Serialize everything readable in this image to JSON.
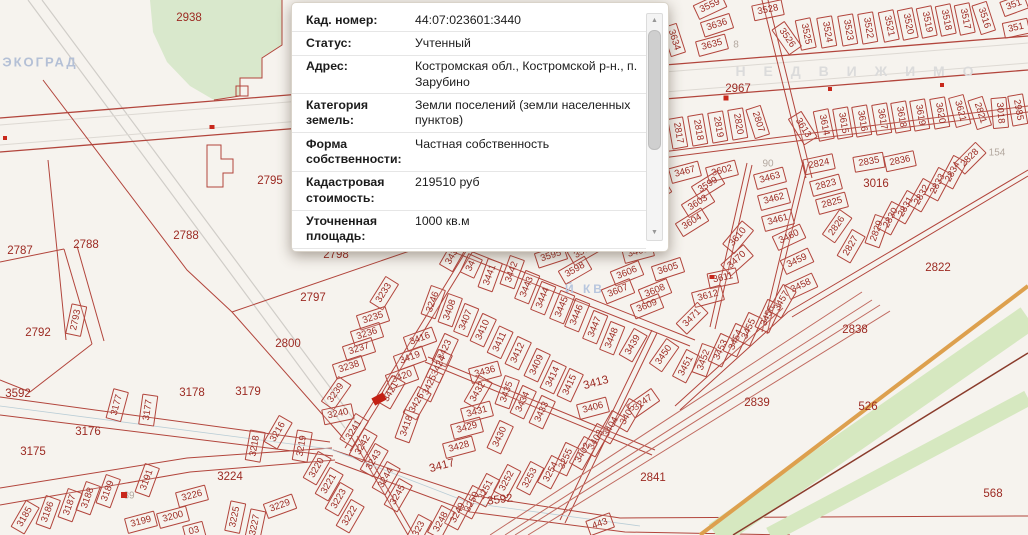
{
  "popup": {
    "rows": [
      {
        "label": "Кад. номер:",
        "value": "44:07:023601:3440"
      },
      {
        "label": "Статус:",
        "value": "Учтенный"
      },
      {
        "label": "Адрес:",
        "value": "Костромская обл., Костромской р-н., п. Зарубино"
      },
      {
        "label": "Категория земель:",
        "value": "Земли поселений (земли населенных пунктов)"
      },
      {
        "label": "Форма собственности:",
        "value": "Частная собственность"
      },
      {
        "label": "Кадастровая стоимость:",
        "value": "219510 руб"
      },
      {
        "label": "Уточненная площадь:",
        "value": "1000 кв.м"
      },
      {
        "label": "",
        "value": "Для индивидуального жилищного"
      }
    ],
    "scrollbar": {
      "up": "▲",
      "down": "▼"
    }
  },
  "colors": {
    "parcel_line": "#b2453c",
    "parcel_label": "#9c2a22",
    "muted_label": "#b3a89f",
    "marker": "#c8281c",
    "selected": "#c32014",
    "forest_green": "#d9e8cc",
    "rail_green": "#d6e8c0",
    "rail_orange": "#dda04e",
    "watermark_blue": "#b4c0d6",
    "watermark_gray": "#dbdbdb"
  },
  "map": {
    "watermarks": [
      {
        "text": "ЭКОГРАД",
        "x": 40,
        "y": 62,
        "size": 13,
        "spacing": 2,
        "color": "#b4c0d6"
      },
      {
        "text": "Н Е Д В И Ж И М О",
        "x": 858,
        "y": 71,
        "size": 14,
        "spacing": 7,
        "color": "#dbdbdb"
      },
      {
        "text": "Й КВ",
        "x": 585,
        "y": 289,
        "size": 12,
        "spacing": 3,
        "color": "#b7c6de"
      }
    ],
    "markers": [
      {
        "x": 726,
        "y": 98,
        "w": 5,
        "h": 5
      },
      {
        "x": 830,
        "y": 89,
        "w": 4,
        "h": 4
      },
      {
        "x": 942,
        "y": 85,
        "w": 4,
        "h": 4
      },
      {
        "x": 212,
        "y": 127,
        "w": 5,
        "h": 4
      },
      {
        "x": 5,
        "y": 138,
        "w": 4,
        "h": 4
      },
      {
        "x": 124,
        "y": 495,
        "w": 6,
        "h": 6
      },
      {
        "x": 712,
        "y": 277,
        "w": 5,
        "h": 4
      },
      {
        "x": 379,
        "y": 399,
        "w": 13,
        "h": 8,
        "r": -28,
        "sel": true
      }
    ],
    "parcels": [
      [
        "3559",
        710,
        6,
        -25
      ],
      [
        "3636",
        717,
        25,
        -18
      ],
      [
        "3634",
        674,
        40,
        72
      ],
      [
        "3635",
        712,
        45,
        -15
      ],
      [
        "8",
        736,
        45,
        0,
        "m"
      ],
      [
        "3528",
        768,
        10,
        -12
      ],
      [
        "3526",
        787,
        38,
        55
      ],
      [
        "3525",
        806,
        34,
        78
      ],
      [
        "3524",
        827,
        32,
        80
      ],
      [
        "3523",
        848,
        30,
        80
      ],
      [
        "3522",
        868,
        28,
        80
      ],
      [
        "3521",
        889,
        26,
        78
      ],
      [
        "3520",
        908,
        24,
        78
      ],
      [
        "3519",
        927,
        22,
        78
      ],
      [
        "3518",
        946,
        20,
        78
      ],
      [
        "3517",
        965,
        19,
        78
      ],
      [
        "3516",
        984,
        18,
        72
      ],
      [
        "351",
        1014,
        5,
        -20
      ],
      [
        "351",
        1016,
        28,
        -12
      ],
      [
        "2967",
        738,
        89,
        0,
        "p"
      ],
      [
        "2817",
        678,
        133,
        80
      ],
      [
        "2818",
        698,
        130,
        80
      ],
      [
        "2819",
        718,
        127,
        80
      ],
      [
        "2820",
        738,
        124,
        80
      ],
      [
        "2807",
        758,
        122,
        72
      ],
      [
        "90",
        768,
        164,
        0,
        "m"
      ],
      [
        "3613",
        803,
        128,
        58
      ],
      [
        "3614",
        824,
        125,
        78
      ],
      [
        "3615",
        843,
        123,
        80
      ],
      [
        "3616",
        862,
        121,
        80
      ],
      [
        "3617",
        882,
        119,
        80
      ],
      [
        "3618",
        901,
        117,
        80
      ],
      [
        "3619",
        920,
        115,
        80
      ],
      [
        "3620",
        940,
        113,
        80
      ],
      [
        "3621",
        960,
        111,
        75
      ],
      [
        "2821",
        980,
        113,
        72
      ],
      [
        "3018",
        1000,
        113,
        85
      ],
      [
        "2985",
        1018,
        110,
        80
      ],
      [
        "154",
        997,
        153,
        0,
        "m"
      ],
      [
        "3467",
        685,
        172,
        -15
      ],
      [
        "3602",
        722,
        171,
        -15
      ],
      [
        "3599",
        708,
        185,
        -32
      ],
      [
        "3603",
        698,
        203,
        -32
      ],
      [
        "3604",
        692,
        222,
        -32
      ],
      [
        "3600",
        655,
        193,
        -32
      ],
      [
        "3610",
        738,
        237,
        -50
      ],
      [
        "3470",
        737,
        260,
        -42
      ],
      [
        "3611",
        723,
        278,
        -12
      ],
      [
        "3612",
        708,
        296,
        -15
      ],
      [
        "3471",
        692,
        318,
        -45
      ],
      [
        "3605",
        668,
        269,
        -18
      ],
      [
        "3606",
        627,
        273,
        -22
      ],
      [
        "3607",
        618,
        291,
        -22
      ],
      [
        "3608",
        655,
        291,
        -22
      ],
      [
        "3609",
        647,
        306,
        -22
      ],
      [
        "3597",
        584,
        251,
        -30
      ],
      [
        "3598",
        575,
        270,
        -30
      ],
      [
        "3595",
        551,
        256,
        -18
      ],
      [
        "3468",
        638,
        252,
        -15
      ],
      [
        "3463",
        770,
        178,
        -15
      ],
      [
        "3462",
        774,
        199,
        -15
      ],
      [
        "3461",
        778,
        220,
        -15
      ],
      [
        "3460",
        789,
        237,
        -25
      ],
      [
        "3459",
        797,
        261,
        -25
      ],
      [
        "3458",
        801,
        286,
        -25
      ],
      [
        "3450",
        664,
        355,
        -55
      ],
      [
        "3451",
        686,
        366,
        -62
      ],
      [
        "3452",
        704,
        360,
        -70
      ],
      [
        "3453",
        721,
        350,
        -65
      ],
      [
        "3454",
        736,
        340,
        -65
      ],
      [
        "3455",
        749,
        329,
        -65
      ],
      [
        "3456",
        768,
        316,
        -65
      ],
      [
        "3457",
        782,
        301,
        -60
      ],
      [
        "2824",
        819,
        164,
        -12
      ],
      [
        "2823",
        826,
        185,
        -15
      ],
      [
        "2825",
        832,
        203,
        -15
      ],
      [
        "2826",
        837,
        226,
        -55
      ],
      [
        "2827",
        851,
        246,
        -60
      ],
      [
        "2829",
        877,
        231,
        -70
      ],
      [
        "2830",
        891,
        218,
        -62
      ],
      [
        "2831",
        906,
        207,
        -60
      ],
      [
        "2832",
        922,
        195,
        -60
      ],
      [
        "2833",
        938,
        184,
        -62
      ],
      [
        "2834",
        953,
        172,
        -62
      ],
      [
        "2828",
        970,
        158,
        -45
      ],
      [
        "2835",
        869,
        162,
        -10
      ],
      [
        "2836",
        900,
        161,
        -12
      ],
      [
        "3016",
        876,
        184,
        0,
        "p"
      ],
      [
        "2822",
        938,
        268,
        0,
        "p"
      ],
      [
        "343",
        452,
        257,
        -60
      ],
      [
        "34",
        471,
        266,
        -65
      ],
      [
        "3441",
        490,
        275,
        -70
      ],
      [
        "3442",
        512,
        272,
        -70
      ],
      [
        "3443",
        527,
        287,
        -68
      ],
      [
        "3444",
        543,
        298,
        -68
      ],
      [
        "3445",
        562,
        307,
        -68
      ],
      [
        "3446",
        577,
        315,
        -68
      ],
      [
        "3447",
        595,
        327,
        -68
      ],
      [
        "3448",
        612,
        338,
        -68
      ],
      [
        "3439",
        633,
        345,
        -60
      ],
      [
        "3246",
        433,
        302,
        -70
      ],
      [
        "3408",
        450,
        310,
        -70
      ],
      [
        "3407",
        466,
        320,
        -68
      ],
      [
        "3410",
        483,
        330,
        -65
      ],
      [
        "3411",
        500,
        342,
        -65
      ],
      [
        "3412",
        518,
        353,
        -65
      ],
      [
        "3409",
        537,
        365,
        -65
      ],
      [
        "3414",
        553,
        377,
        -65
      ],
      [
        "3415",
        570,
        385,
        -65
      ],
      [
        "3413",
        596,
        383,
        -15,
        "p"
      ],
      [
        "3416",
        420,
        339,
        -20
      ],
      [
        "3419",
        410,
        358,
        -20
      ],
      [
        "3420",
        402,
        377,
        -20
      ],
      [
        "3421",
        391,
        392,
        -60
      ],
      [
        "3423",
        445,
        350,
        -65
      ],
      [
        "3424",
        439,
        366,
        -65
      ],
      [
        "3425",
        430,
        385,
        -65
      ],
      [
        "3426",
        417,
        403,
        -60
      ],
      [
        "3418",
        407,
        426,
        -70
      ],
      [
        "3436",
        485,
        372,
        -15
      ],
      [
        "3432",
        478,
        392,
        -60
      ],
      [
        "3435",
        507,
        392,
        -70
      ],
      [
        "3434",
        523,
        402,
        -65
      ],
      [
        "3433",
        542,
        412,
        -65
      ],
      [
        "3431",
        477,
        412,
        -15
      ],
      [
        "3429",
        467,
        428,
        -15
      ],
      [
        "3430",
        500,
        437,
        -65
      ],
      [
        "3428",
        459,
        447,
        -15
      ],
      [
        "3417",
        442,
        466,
        -15,
        "p"
      ],
      [
        "3406",
        593,
        408,
        -15
      ],
      [
        "3247",
        643,
        403,
        -35
      ],
      [
        "3405",
        628,
        415,
        -60
      ],
      [
        "3404",
        611,
        427,
        -60
      ],
      [
        "3403",
        596,
        440,
        -60
      ],
      [
        "3402",
        583,
        453,
        -60
      ],
      [
        "3255",
        566,
        459,
        -65
      ],
      [
        "3254",
        551,
        472,
        -62
      ],
      [
        "3253",
        530,
        478,
        -62
      ],
      [
        "3252",
        507,
        481,
        -62
      ],
      [
        "3251",
        486,
        490,
        -62
      ],
      [
        "3250",
        472,
        502,
        -62
      ],
      [
        "3249",
        458,
        513,
        -62
      ],
      [
        "3248",
        441,
        522,
        -62
      ],
      [
        "323",
        419,
        529,
        -62
      ],
      [
        "443",
        600,
        524,
        -20
      ],
      [
        "3592",
        500,
        500,
        -8,
        "p"
      ],
      [
        "2841",
        653,
        478,
        0,
        "p"
      ],
      [
        "2839",
        757,
        403,
        0,
        "p"
      ],
      [
        "2838",
        855,
        330,
        0,
        "p"
      ],
      [
        "526",
        868,
        407,
        0,
        "p"
      ],
      [
        "568",
        993,
        494,
        0,
        "p"
      ],
      [
        "3233",
        384,
        293,
        -58
      ],
      [
        "3235",
        373,
        318,
        -18
      ],
      [
        "3236",
        367,
        334,
        -18
      ],
      [
        "3237",
        359,
        349,
        -18
      ],
      [
        "3238",
        349,
        367,
        -18
      ],
      [
        "3239",
        336,
        393,
        -55
      ],
      [
        "3240",
        338,
        414,
        -12
      ],
      [
        "3241",
        354,
        430,
        -58
      ],
      [
        "2938",
        189,
        18,
        0,
        "p"
      ],
      [
        "2795",
        270,
        181,
        0,
        "p"
      ],
      [
        "2787",
        20,
        251,
        0,
        "p"
      ],
      [
        "2788",
        86,
        245,
        0,
        "p"
      ],
      [
        "2788",
        186,
        236,
        0,
        "p"
      ],
      [
        "2792",
        38,
        333,
        0,
        "p"
      ],
      [
        "2793",
        76,
        320,
        -78
      ],
      [
        "2800",
        288,
        344,
        0,
        "p"
      ],
      [
        "2797",
        313,
        298,
        0,
        "p"
      ],
      [
        "2798",
        336,
        255,
        0,
        "p"
      ],
      [
        "3592",
        18,
        394,
        0,
        "p"
      ],
      [
        "3175",
        33,
        452,
        0,
        "p"
      ],
      [
        "3176",
        88,
        432,
        0,
        "p"
      ],
      [
        "3177",
        117,
        405,
        -75
      ],
      [
        "3177",
        148,
        410,
        -82
      ],
      [
        "3178",
        192,
        393,
        0,
        "p"
      ],
      [
        "3179",
        248,
        392,
        0,
        "p"
      ],
      [
        "3185",
        25,
        517,
        -60
      ],
      [
        "3186",
        48,
        512,
        -70
      ],
      [
        "3187",
        70,
        505,
        -70
      ],
      [
        "3188",
        88,
        498,
        -70
      ],
      [
        "3189",
        108,
        491,
        -70
      ],
      [
        "89",
        129,
        496,
        0,
        "m"
      ],
      [
        "3191",
        147,
        480,
        -70
      ],
      [
        "3226",
        192,
        496,
        -15
      ],
      [
        "3224",
        230,
        477,
        0,
        "p"
      ],
      [
        "3199",
        141,
        522,
        -15
      ],
      [
        "3200",
        173,
        517,
        -15
      ],
      [
        "03",
        194,
        531,
        -15
      ],
      [
        "3225",
        235,
        517,
        -78
      ],
      [
        "3227",
        255,
        525,
        -78
      ],
      [
        "3229",
        280,
        506,
        -20
      ],
      [
        "3216",
        278,
        432,
        -60
      ],
      [
        "3218",
        255,
        446,
        -80
      ],
      [
        "3219",
        302,
        446,
        -80
      ],
      [
        "3220",
        317,
        468,
        -60
      ],
      [
        "3221",
        329,
        484,
        -60
      ],
      [
        "3223",
        339,
        499,
        -60
      ],
      [
        "3222",
        350,
        516,
        -60
      ],
      [
        "3242",
        363,
        445,
        -60
      ],
      [
        "3243",
        374,
        460,
        -60
      ],
      [
        "3244",
        386,
        478,
        -60
      ],
      [
        "3245",
        398,
        495,
        -60
      ]
    ]
  }
}
